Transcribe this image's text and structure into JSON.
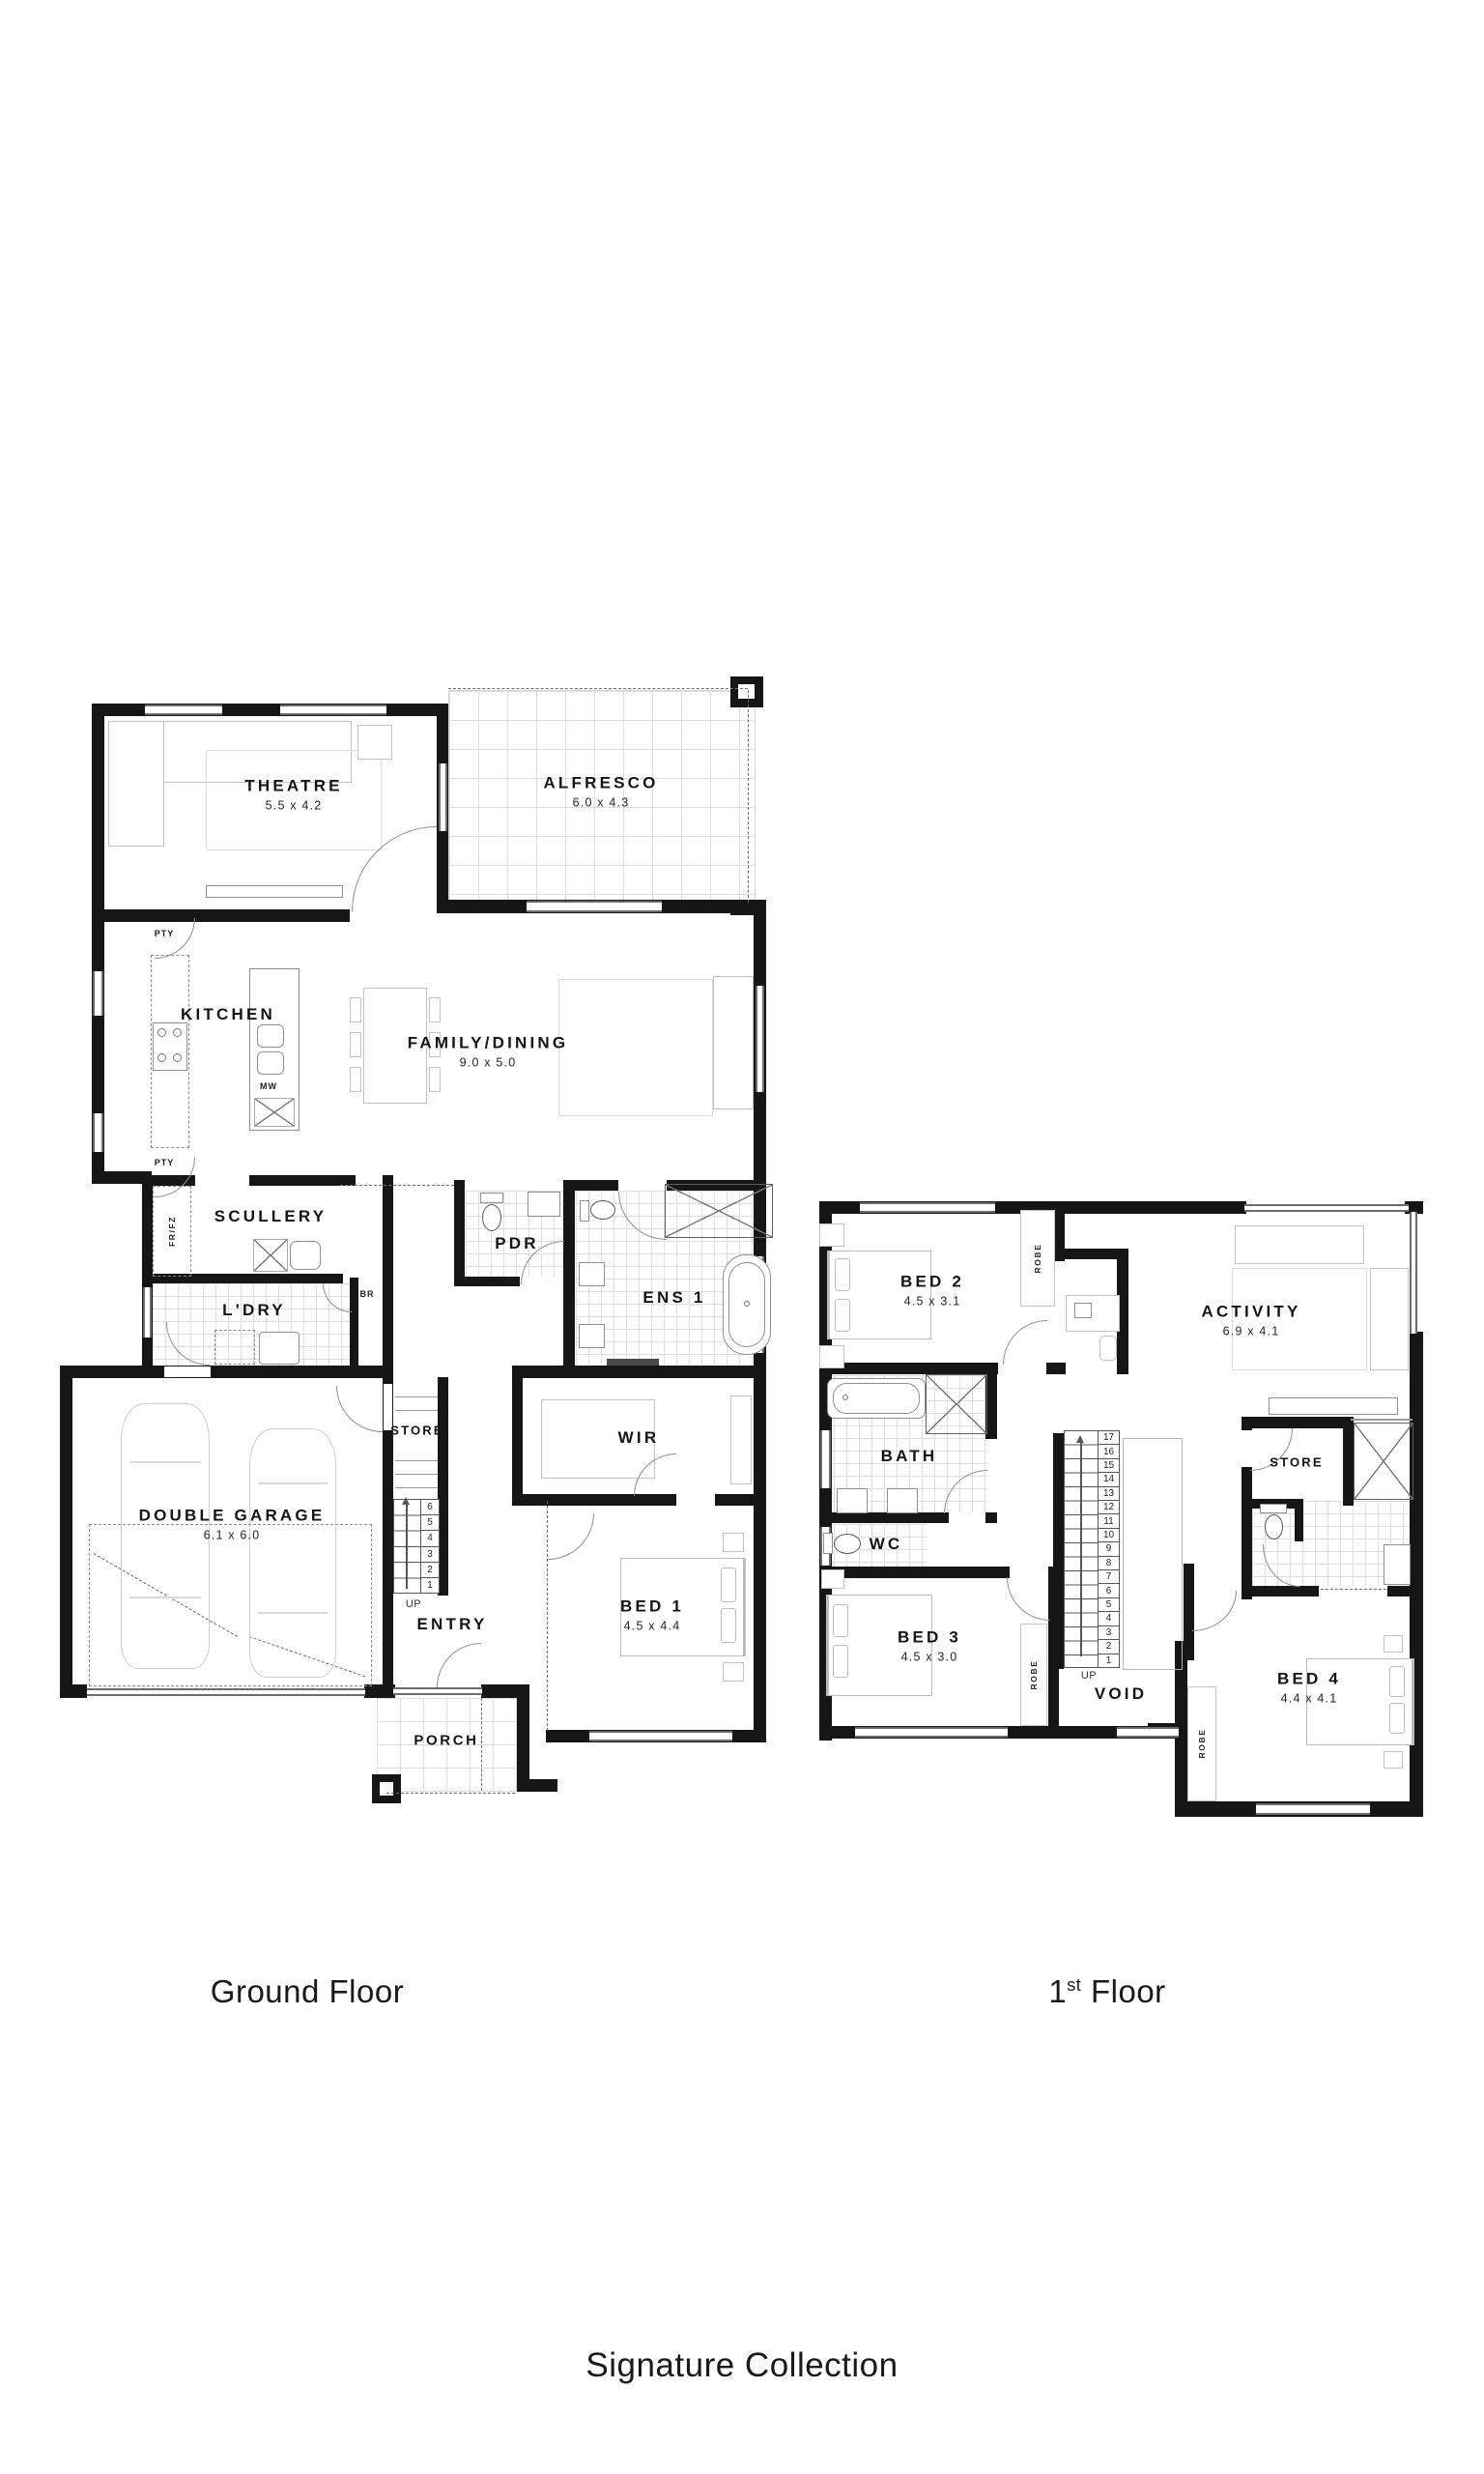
{
  "titles": {
    "ground_floor": "Ground Floor",
    "first_floor_num": "1",
    "first_floor_sup": "st",
    "first_floor_word": " Floor",
    "collection": "Signature Collection"
  },
  "ground_floor": {
    "theatre": {
      "name": "THEATRE",
      "dims": "5.5 x 4.2"
    },
    "alfresco": {
      "name": "ALFRESCO",
      "dims": "6.0 x 4.3"
    },
    "kitchen": {
      "name": "KITCHEN"
    },
    "family_dining": {
      "name": "FAMILY/DINING",
      "dims": "9.0 x 5.0"
    },
    "scullery": {
      "name": "SCULLERY"
    },
    "laundry": {
      "name": "L'DRY"
    },
    "pdr": {
      "name": "PDR"
    },
    "ens1": {
      "name": "ENS 1"
    },
    "garage": {
      "name": "DOUBLE GARAGE",
      "dims": "6.1 x 6.0"
    },
    "store": {
      "name": "STORE"
    },
    "entry": {
      "name": "ENTRY"
    },
    "wir": {
      "name": "WIR"
    },
    "bed1": {
      "name": "BED 1",
      "dims": "4.5 x 4.4"
    },
    "porch": {
      "name": "PORCH"
    },
    "pty": "PTY",
    "fridge": "FR/FZ",
    "broom": "BR",
    "microwave": "MW",
    "up": "UP",
    "stair_numbers": [
      "6",
      "5",
      "4",
      "3",
      "2",
      "1"
    ]
  },
  "first_floor": {
    "bed2": {
      "name": "BED 2",
      "dims": "4.5 x 3.1"
    },
    "activity": {
      "name": "ACTIVITY",
      "dims": "6.9 x 4.1"
    },
    "bath": {
      "name": "BATH"
    },
    "wc": {
      "name": "WC"
    },
    "store": {
      "name": "STORE"
    },
    "bed3": {
      "name": "BED 3",
      "dims": "4.5 x 3.0"
    },
    "bed4": {
      "name": "BED 4",
      "dims": "4.4 x 4.1"
    },
    "void": {
      "name": "VOID"
    },
    "robe": "ROBE",
    "up": "UP",
    "stair_numbers": [
      "17",
      "16",
      "15",
      "14",
      "13",
      "12",
      "11",
      "10",
      "9",
      "8",
      "7",
      "6",
      "5",
      "4",
      "3",
      "2",
      "1"
    ]
  }
}
